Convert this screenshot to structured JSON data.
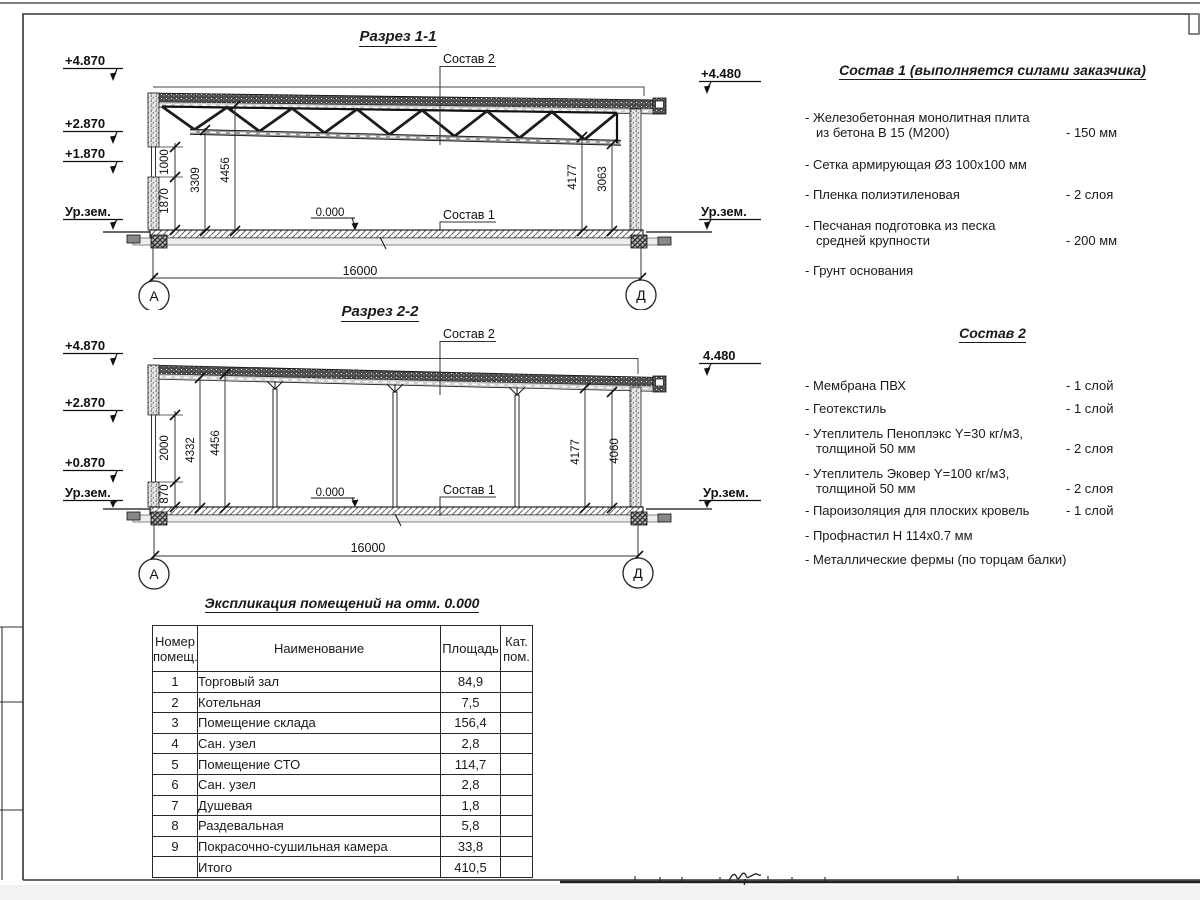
{
  "sections": {
    "s1": {
      "title": "Разрез 1-1",
      "elev": [
        "+4.870",
        "+2.870",
        "+1.870"
      ],
      "ground": "Ур.зем.",
      "elev_right": "+4.480",
      "ground_right": "Ур.зем.",
      "dim_1000": "1000",
      "dim_1870": "1870",
      "dim_3309": "3309",
      "dim_4456": "4456",
      "dim_4177": "4177",
      "dim_3063": "3063",
      "zero": "0.000",
      "label_sostav1": "Состав 1",
      "label_sostav2": "Состав 2",
      "width_dim": "16000",
      "axis_a": "А",
      "axis_d": "Д"
    },
    "s2": {
      "title": "Разрез 2-2",
      "elev": [
        "+4.870",
        "+2.870",
        "+0.870"
      ],
      "ground": "Ур.зем.",
      "elev_right": "4.480",
      "ground_right": "Ур.зем.",
      "dim_870": "870",
      "dim_2000": "2000",
      "dim_4332": "4332",
      "dim_4456": "4456",
      "dim_4177": "4177",
      "dim_4060": "4060",
      "zero": "0.000",
      "label_sostav1": "Состав 1",
      "label_sostav2": "Состав 2",
      "width_dim": "16000",
      "axis_a": "А",
      "axis_d": "Д"
    }
  },
  "sostav1": {
    "title": "Состав 1 (выполняется силами заказчика)",
    "items": [
      {
        "text": "- Железобетонная  монолитная плита\nиз бетона В 15 (М200)",
        "value": "- 150 мм"
      },
      {
        "text": "- Сетка армирующая Ø3 100х100 мм",
        "value": ""
      },
      {
        "text": "- Пленка полиэтиленовая",
        "value": "-  2 слоя"
      },
      {
        "text": "- Песчаная подготовка из песка\nсредней крупности",
        "value": "- 200 мм"
      },
      {
        "text": "- Грунт основания",
        "value": ""
      }
    ]
  },
  "sostav2": {
    "title": "Состав 2",
    "items": [
      {
        "text": "- Мембрана ПВХ",
        "value": "- 1 слой"
      },
      {
        "text": "- Геотекстиль",
        "value": "- 1 слой"
      },
      {
        "text": "- Утеплитель Пеноплэкс Y=30 кг/м3,\nтолщиной 50 мм",
        "value": "- 2 слоя"
      },
      {
        "text": "- Утеплитель Эковер Y=100 кг/м3,\nтолщиной 50 мм",
        "value": "- 2 слоя"
      },
      {
        "text": "- Пароизоляция для плоских кровель",
        "value": "- 1 слой"
      },
      {
        "text": "- Профнастил Н 114х0.7 мм",
        "value": ""
      },
      {
        "text": "- Металлические фермы (по торцам балки)",
        "value": ""
      }
    ]
  },
  "table": {
    "title": "Экспликация помещений на отм. 0.000",
    "col_num": "Номер\nпомещ.",
    "col_name": "Наименование",
    "col_area": "Площадь",
    "col_cat": "Кат.\nпом.",
    "rows": [
      {
        "num": "1",
        "name": "Торговый зал",
        "area": "84,9",
        "cat": ""
      },
      {
        "num": "2",
        "name": "Котельная",
        "area": "7,5",
        "cat": ""
      },
      {
        "num": "3",
        "name": "Помещение склада",
        "area": "156,4",
        "cat": ""
      },
      {
        "num": "4",
        "name": "Сан. узел",
        "area": "2,8",
        "cat": ""
      },
      {
        "num": "5",
        "name": "Помещение СТО",
        "area": "114,7",
        "cat": ""
      },
      {
        "num": "6",
        "name": "Сан. узел",
        "area": "2,8",
        "cat": ""
      },
      {
        "num": "7",
        "name": "Душевая",
        "area": "1,8",
        "cat": ""
      },
      {
        "num": "8",
        "name": "Раздевальная",
        "area": "5,8",
        "cat": ""
      },
      {
        "num": "9",
        "name": "Покрасочно-сушильная камера",
        "area": "33,8",
        "cat": ""
      },
      {
        "num": "",
        "name": "Итого",
        "area": "410,5",
        "cat": ""
      }
    ]
  }
}
